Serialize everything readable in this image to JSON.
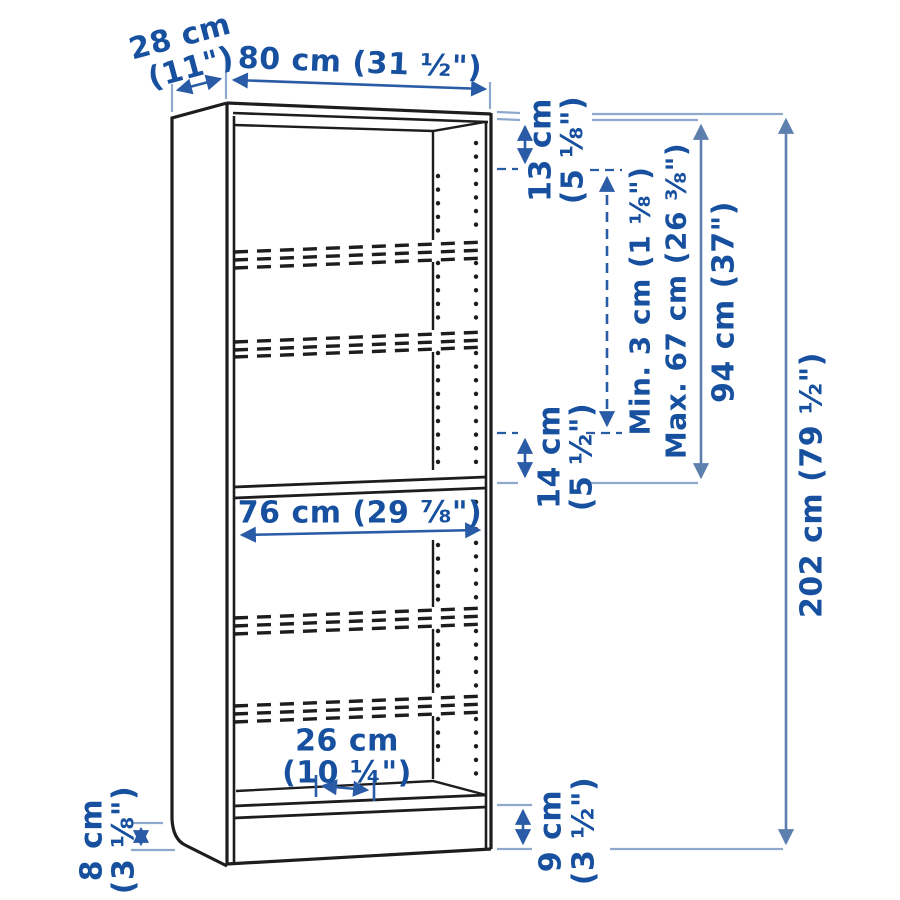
{
  "diagram": {
    "kind": "bookcase-dimension-diagram",
    "colors": {
      "background": "#ffffff",
      "outline_ink": "#1d1d1f",
      "label_blue": "#17509f",
      "arrow_blue": "#2a5ba6",
      "dimension_line_blue": "#5c7fae",
      "extension_line_blue": "#8ea9cc"
    },
    "dims": {
      "depth": {
        "l1": "28 cm",
        "l2": "(11\")"
      },
      "width": {
        "l1": "80 cm (31 ½\")"
      },
      "top_gap": {
        "l1": "13 cm",
        "l2": "(5 ⅛\")"
      },
      "shelf_min_max": {
        "l1": "Min. 3 cm (1 ⅛\")",
        "l2": "Max. 67 cm (26 ⅜\")"
      },
      "upper_section": {
        "l1": "94 cm (37\")"
      },
      "total_height": {
        "l1": "202 cm (79 ½\")"
      },
      "mid_gap": {
        "l1": "14 cm",
        "l2": "(5 ½\")"
      },
      "inner_width": {
        "l1": "76 cm (29 ⅞\")"
      },
      "inner_depth": {
        "l1": "26 cm",
        "l2": "(10 ¼\")"
      },
      "base_left": {
        "l1": "8 cm",
        "l2": "(3 ⅛\")"
      },
      "base_right": {
        "l1": "9 cm",
        "l2": "(3 ½\")"
      }
    }
  }
}
